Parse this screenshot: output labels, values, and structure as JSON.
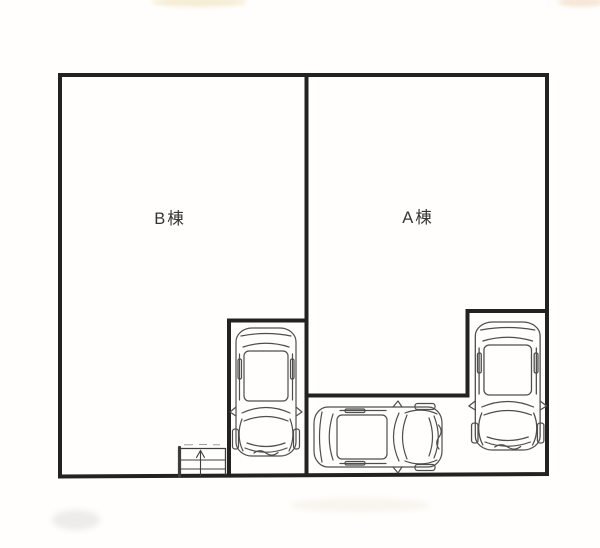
{
  "plan": {
    "building_b": {
      "label": "B棟"
    },
    "building_a": {
      "label": "A棟"
    },
    "colors": {
      "wall": "#222222",
      "detail_line": "#4e4e4e",
      "stair_line": "#3d3d3d",
      "label_text": "#353535",
      "background": "#fffefc"
    },
    "icons": {
      "cars": [
        "car-top-view-left",
        "car-top-view-center",
        "car-top-view-right"
      ],
      "staircase": "staircase-with-up-arrow"
    }
  }
}
